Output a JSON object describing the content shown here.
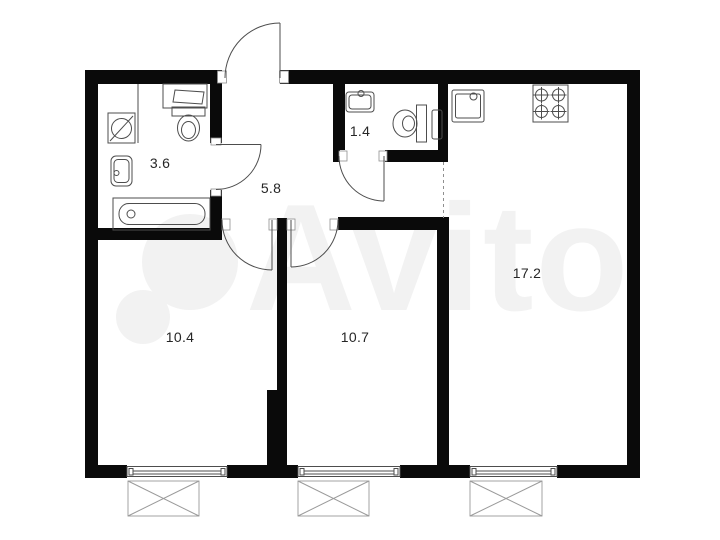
{
  "colors": {
    "wall-color": "#0a0a0a",
    "line-color": "#4d4d4d",
    "label-color": "#262626",
    "watermark-color": "#f2f2f2"
  },
  "plan": {
    "type": "apartment-floor-plan",
    "watermark": "Avito",
    "rooms": [
      {
        "id": "bathroom",
        "area_label": "3.6",
        "fixtures": [
          "washing-machine",
          "counter-sink",
          "toilet",
          "hand-sink",
          "bathtub"
        ]
      },
      {
        "id": "wc",
        "area_label": "1.4",
        "fixtures": [
          "sink",
          "toilet",
          "towel-radiator"
        ]
      },
      {
        "id": "hallway",
        "area_label": "5.8",
        "fixtures": []
      },
      {
        "id": "room-left",
        "area_label": "10.4",
        "fixtures": [
          "window",
          "window-sill"
        ]
      },
      {
        "id": "room-middle",
        "area_label": "10.7",
        "fixtures": [
          "window",
          "window-sill"
        ]
      },
      {
        "id": "kitchen-living",
        "area_label": "17.2",
        "fixtures": [
          "kitchen-sink",
          "stove-4-burner",
          "window",
          "window-sill"
        ]
      }
    ]
  }
}
